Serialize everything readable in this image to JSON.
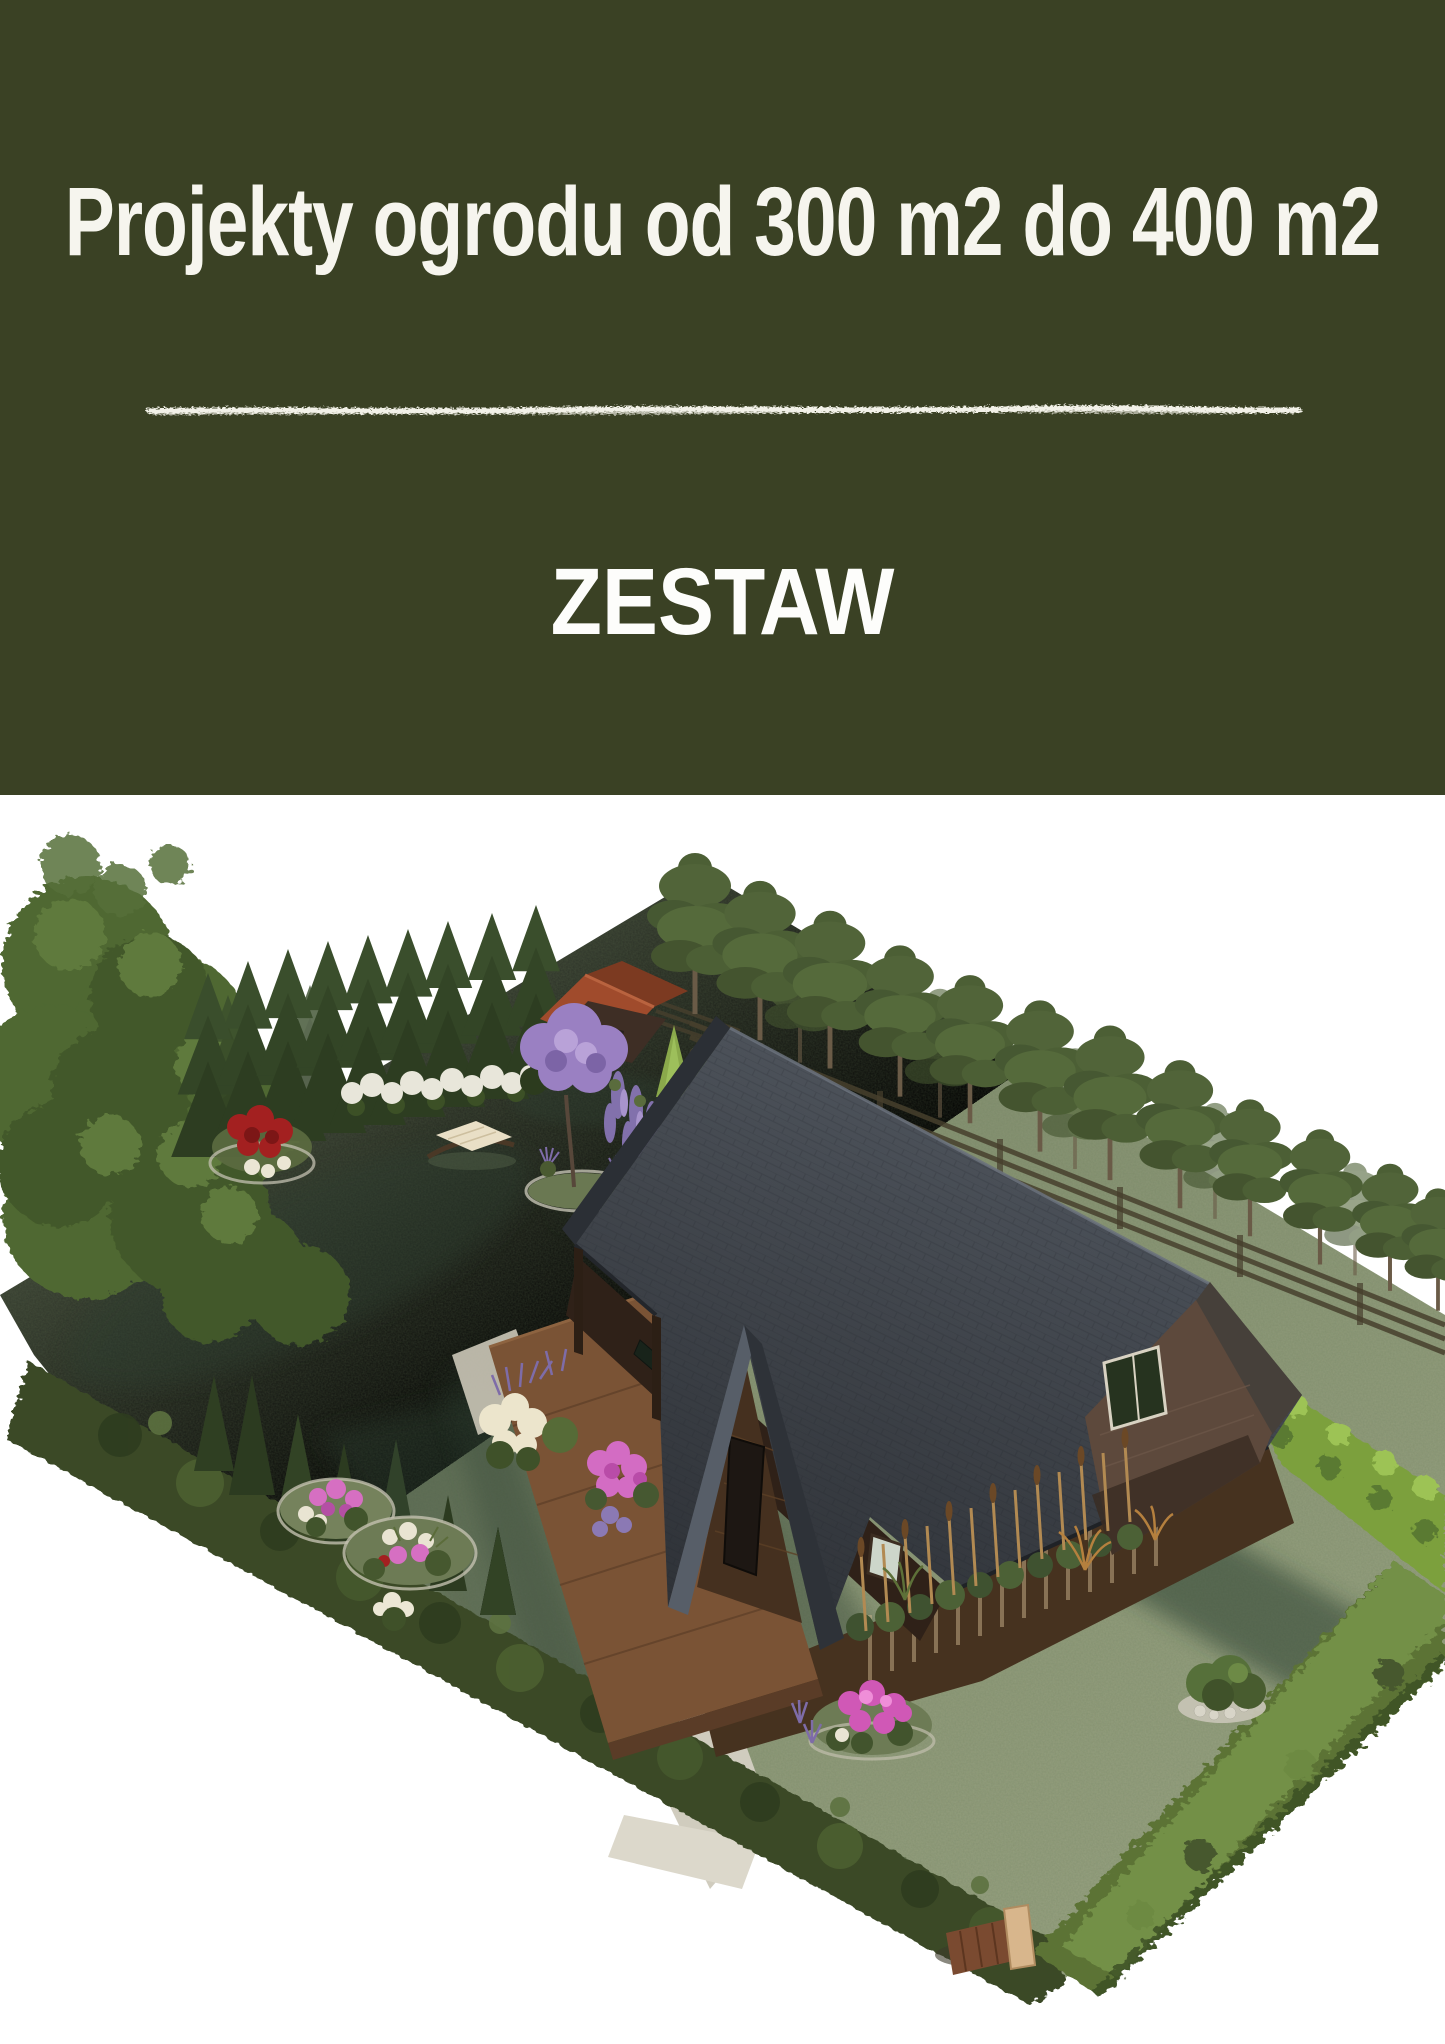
{
  "page": {
    "width_px": 1445,
    "height_px": 2044,
    "background": "#ffffff"
  },
  "header": {
    "title": "Projekty ogrodu od 300 m2 do 400 m2",
    "subtitle": "ZESTAW",
    "background_color": "#3a4124",
    "title_color": "#f6f5ee",
    "subtitle_color": "#fdfdfb",
    "divider_color": "#f2f1e8",
    "divider_style": "hand-drawn chalk line"
  },
  "illustration": {
    "type": "3d-garden-render",
    "alt": "Isometric 3D visualization of a 300-400 m2 garden: wooden cottage with dark shingle roof and porch deck, gravel path, flower beds, lavender, boundary hedges, spruce and pine rows, red-roofed shed and a hammock",
    "background": "#ffffff",
    "colors": {
      "lawn": "#879174",
      "lawn_shadow": "#5c6a4e",
      "hedge_dark": "#3a4a28",
      "hedge_bright": "#7ba03d",
      "hedge_bottom": "#5c7336",
      "tree_canopy": "#4f6831",
      "spruce": "#36492a",
      "pine": "#4c5f35",
      "roof": "#42464c",
      "roof_light": "#575e68",
      "wood_wall": "#46321f",
      "gable_wall": "#5d493c",
      "porch_wood": "#7a5335",
      "shed_roof": "#a04b2c",
      "path_gravel": "#d0ccbe",
      "paver": "#dcd8cb",
      "stone_edging": "#c3c0af",
      "flower_red": "#a32020",
      "flower_pink": "#d66fc2",
      "flower_magenta": "#d058b6",
      "flower_white": "#e9e4d2",
      "flower_purple": "#8a77b8",
      "lilac": "#9a80c2",
      "hydrangea": "#e8e6da",
      "cattail": "#b28a52",
      "fence": "#473f2d",
      "gate_post": "#d8b68c",
      "gate_planks": "#7a4a30",
      "hammock_fabric": "#e9dfc6"
    }
  }
}
